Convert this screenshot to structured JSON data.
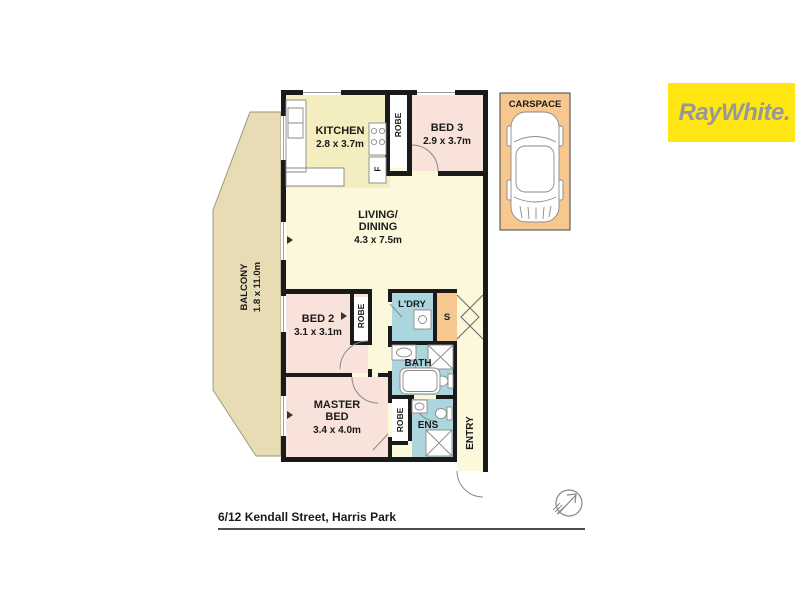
{
  "brand": {
    "logo_text": "RayWhite.",
    "logo_bg": "#FFE512",
    "logo_color": "#96989B"
  },
  "footer": {
    "address": "6/12 Kendall Street, Harris Park"
  },
  "plan": {
    "balcony": {
      "name": "BALCONY",
      "dims": "1.8 x 11.0m"
    },
    "kitchen": {
      "name": "KITCHEN",
      "dims": "2.8 x 3.7m"
    },
    "bed3": {
      "name": "BED 3",
      "dims": "2.9 x 3.7m"
    },
    "living": {
      "line1": "LIVING/",
      "line2": "DINING",
      "dims": "4.3 x 7.5m"
    },
    "bed2": {
      "name": "BED 2",
      "dims": "3.1 x 3.1m"
    },
    "master": {
      "line1": "MASTER",
      "line2": "BED",
      "dims": "3.4 x 4.0m"
    },
    "laundry": {
      "name": "L'DRY"
    },
    "storage": {
      "name": "S"
    },
    "bath": {
      "name": "BATH"
    },
    "ensuite": {
      "name": "ENS"
    },
    "entry": {
      "name": "ENTRY"
    },
    "robe": {
      "name": "ROBE"
    },
    "fridge": {
      "name": "F"
    },
    "carspace": {
      "name": "CARSPACE"
    }
  },
  "colors": {
    "living": "#FCF8DB",
    "kitchen": "#F4EDC0",
    "bedroom": "#F8E2DA",
    "wet_area": "#ABD6DD",
    "storage": "#F6C78F",
    "balcony": "#E7DCB4",
    "wall": "#1A1A1A"
  }
}
